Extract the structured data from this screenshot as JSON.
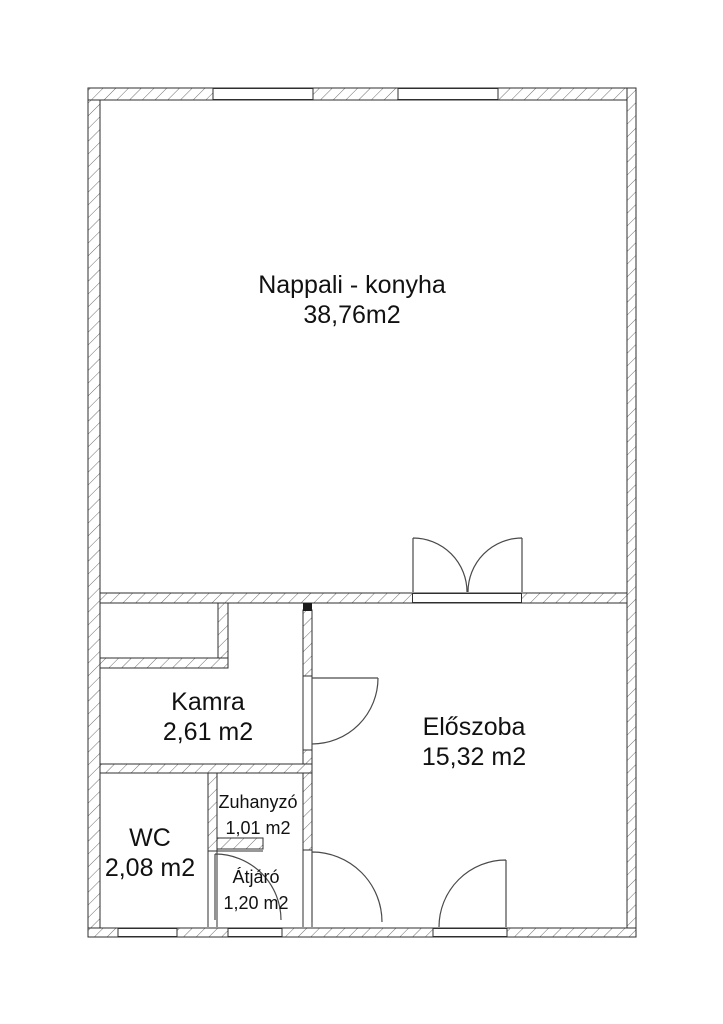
{
  "plan": {
    "title": "Floor plan",
    "rooms": [
      {
        "name": "Nappali - konyha",
        "area": "38,76m2"
      },
      {
        "name": "Kamra",
        "area": "2,61 m2"
      },
      {
        "name": "Előszoba",
        "area": "15,32 m2"
      },
      {
        "name": "WC",
        "area": "2,08 m2"
      },
      {
        "name": "Zuhanyzó",
        "area": "1,01 m2"
      },
      {
        "name": "Átjáró",
        "area": "1,20 m2"
      }
    ],
    "colors": {
      "background": "#ffffff",
      "wall_outline": "#2f2f2f",
      "wall_hatch": "#6e6e6e",
      "door_swing": "#4a4a4a",
      "text": "#111111"
    }
  }
}
